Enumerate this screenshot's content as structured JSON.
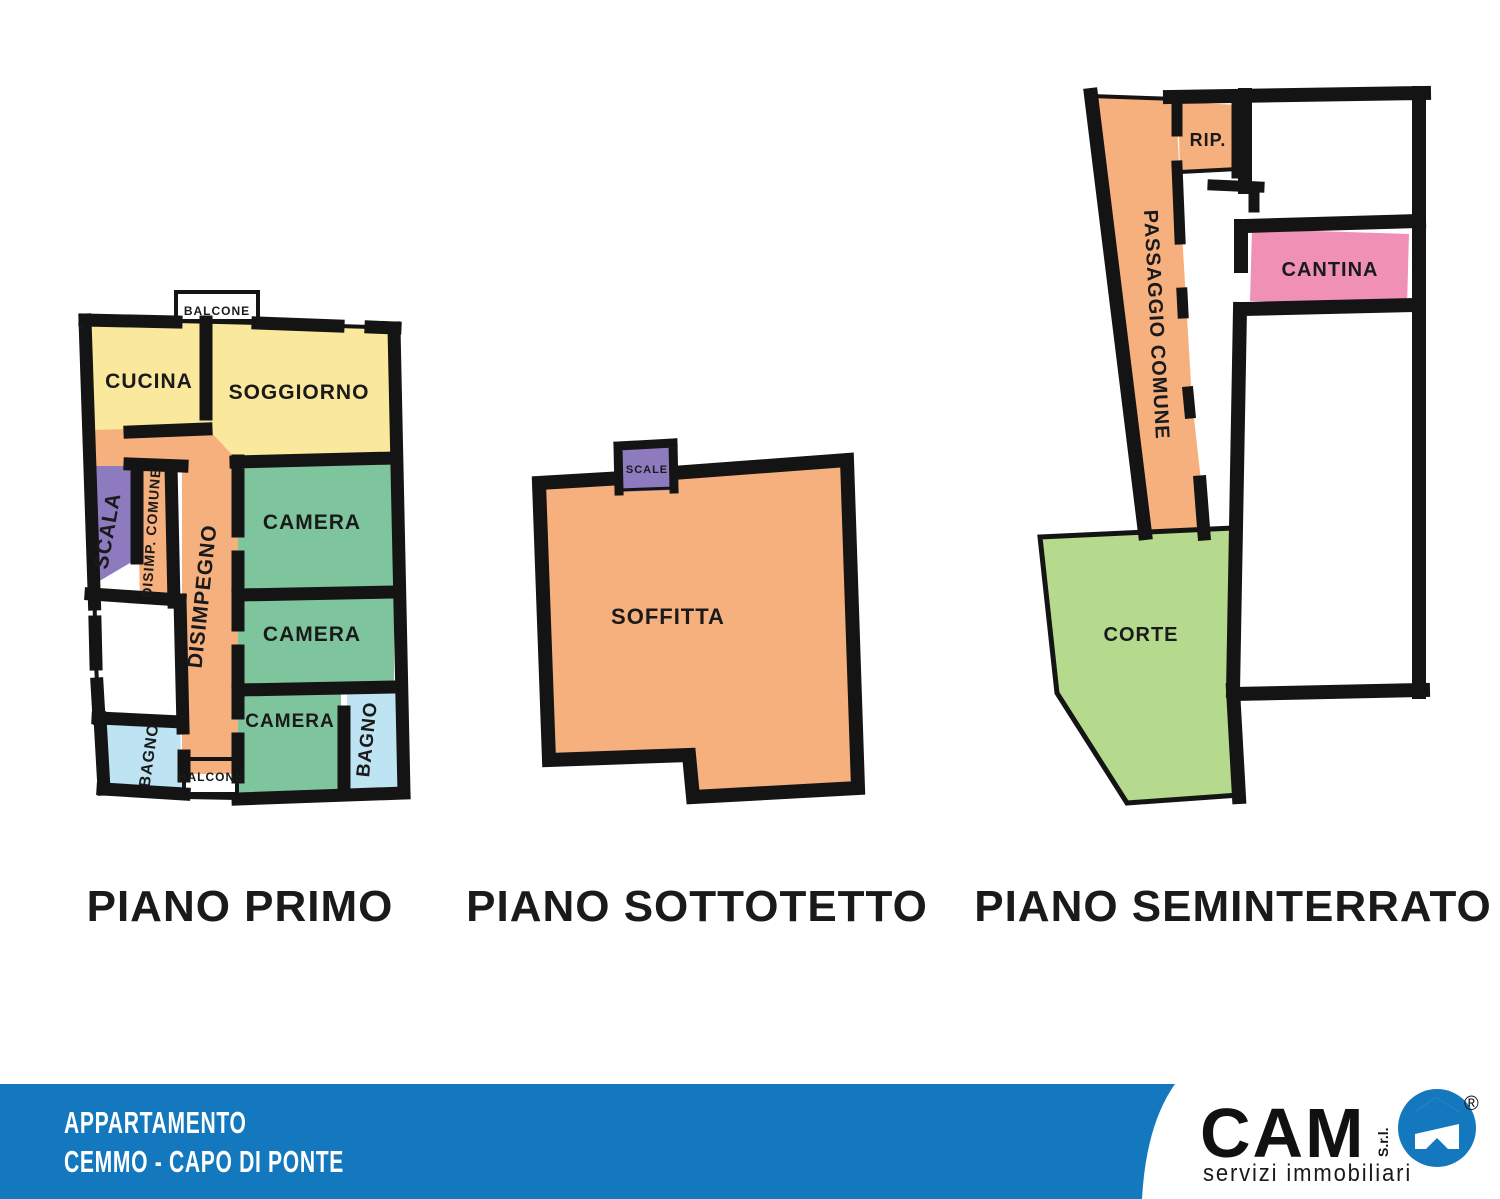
{
  "colors": {
    "wall": "#141414",
    "yellow": "#FAE89C",
    "gold": "#F5C31D",
    "orange": "#F6B07E",
    "green": "#7EC59D",
    "lightblue": "#BEE3F2",
    "purple": "#8E7BBF",
    "pink": "#F190B5",
    "corte_green": "#B6DA8D",
    "footer_blue": "#1478BE",
    "label": "#1A1A1A",
    "white": "#FFFFFF"
  },
  "plans": [
    {
      "title": "PIANO PRIMO",
      "rooms": {
        "balcone": "BALCONE",
        "cucina": "CUCINA",
        "soggiorno": "SOGGIORNO",
        "scala": "SCALA",
        "disimp_comune": "DISIMP. COMUNE",
        "disimpegno": "DISIMPEGNO",
        "camera": "CAMERA",
        "bagno": "BAGNO"
      }
    },
    {
      "title": "PIANO SOTTOTETTO",
      "rooms": {
        "scale": "SCALE",
        "soffitta": "SOFFITTA"
      }
    },
    {
      "title": "PIANO SEMINTERRATO",
      "rooms": {
        "passaggio": "PASSAGGIO COMUNE",
        "rip": "RIP.",
        "cantina": "CANTINA",
        "corte": "CORTE"
      }
    }
  ],
  "footer": {
    "line1": "APPARTAMENTO",
    "line2": "CEMMO - CAPO DI PONTE",
    "logo": {
      "name": "CAM",
      "suffix": "S.r.l.",
      "registered": "®",
      "tagline": "servizi immobiliari"
    }
  }
}
